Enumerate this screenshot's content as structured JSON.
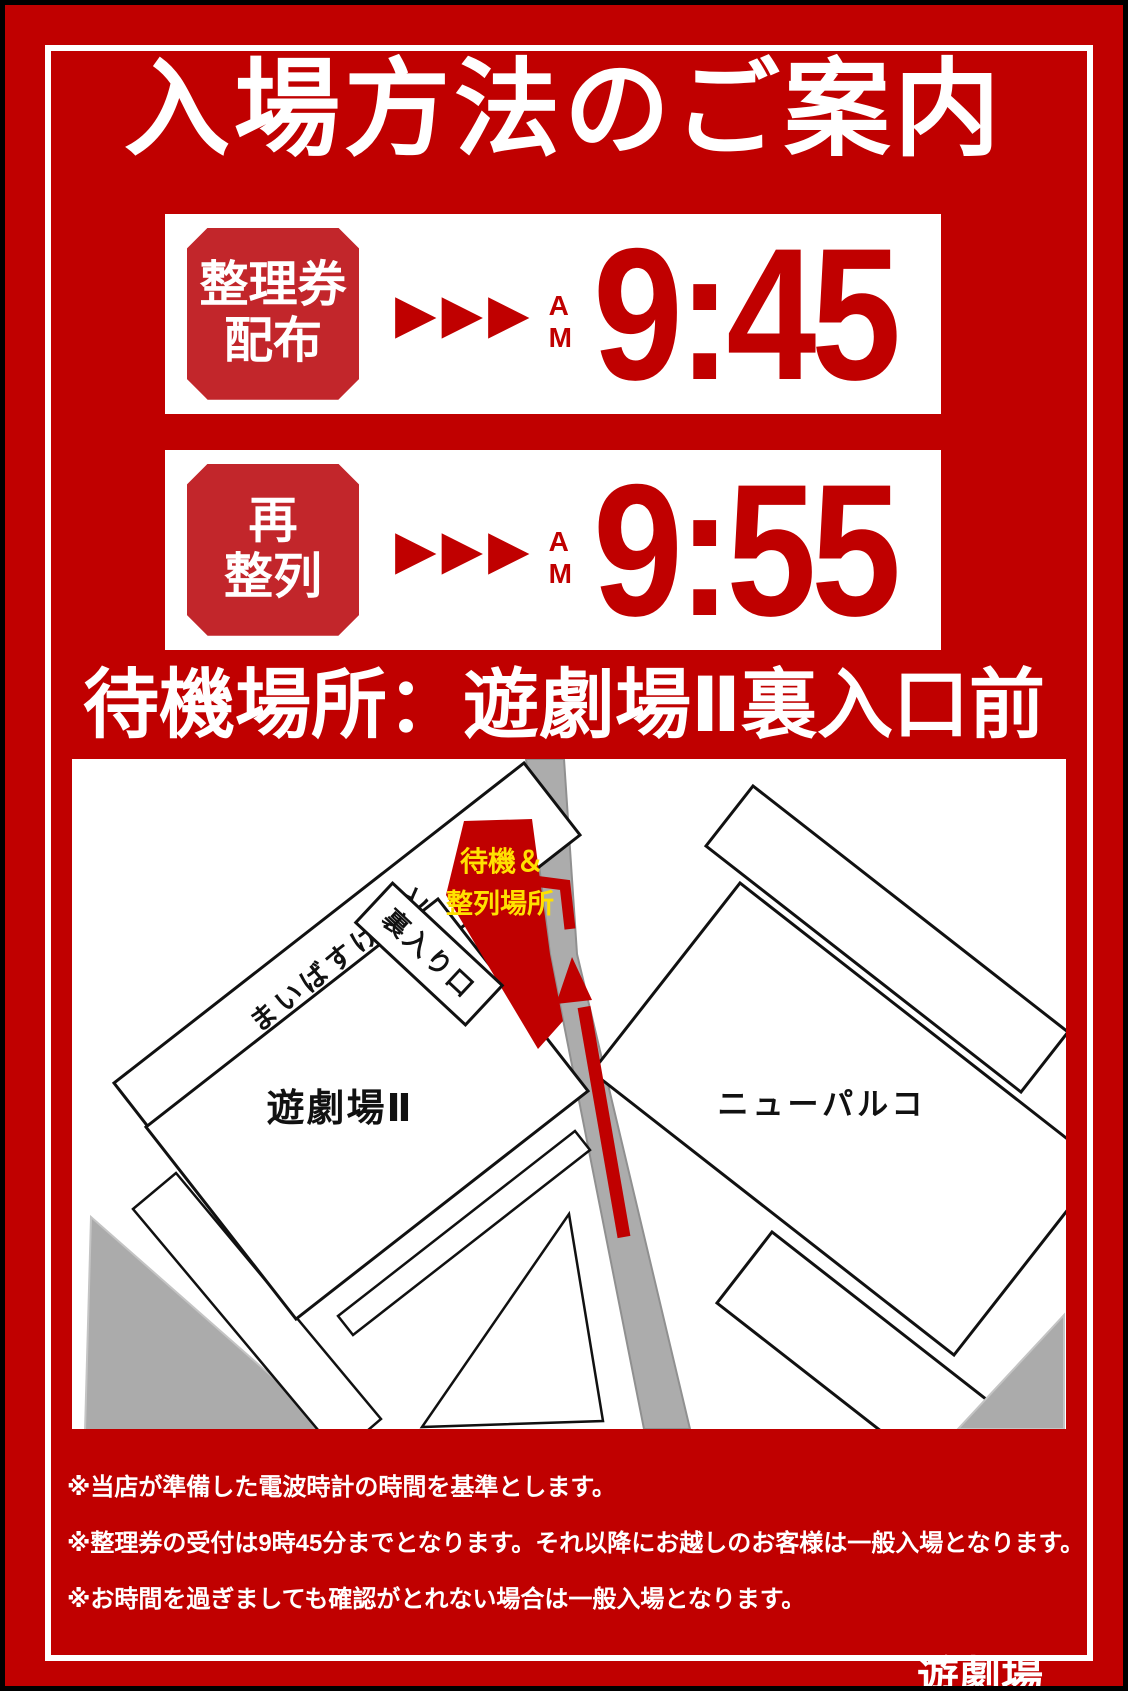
{
  "poster": {
    "title": "入場方法のご案内",
    "schedule": [
      {
        "badge_line1": "整理券",
        "badge_line2": "配布",
        "arrows": "▶▶▶",
        "meridiem": "AM",
        "time": "9:45"
      },
      {
        "badge_line1": "再",
        "badge_line2": "整列",
        "arrows": "▶▶▶",
        "meridiem": "AM",
        "time": "9:55"
      }
    ],
    "waiting_heading": "待機場所：遊劇場Ⅱ裏入口前",
    "map": {
      "labels": {
        "store_strip": "まいばすけっと",
        "theater": "遊劇場Ⅱ",
        "back_entrance": "裏入り口",
        "waiting_line1": "待機＆",
        "waiting_line2": "整列場所",
        "parco": "ニューパルコ"
      }
    },
    "notes": [
      "※当店が準備した電波時計の時間を基準とします。",
      "※整理券の受付は9時45分までとなります。それ以降にお越しのお客様は一般入場となります。",
      "※お時間を過ぎましても確認がとれない場合は一般入場となります。"
    ],
    "signature": "遊劇場",
    "colors": {
      "background_red": "#C00000",
      "badge_red": "#C2262B",
      "accent_yellow": "#FFE100",
      "road_gray": "#ACACAC",
      "block_gray": "#ABABAB"
    }
  }
}
